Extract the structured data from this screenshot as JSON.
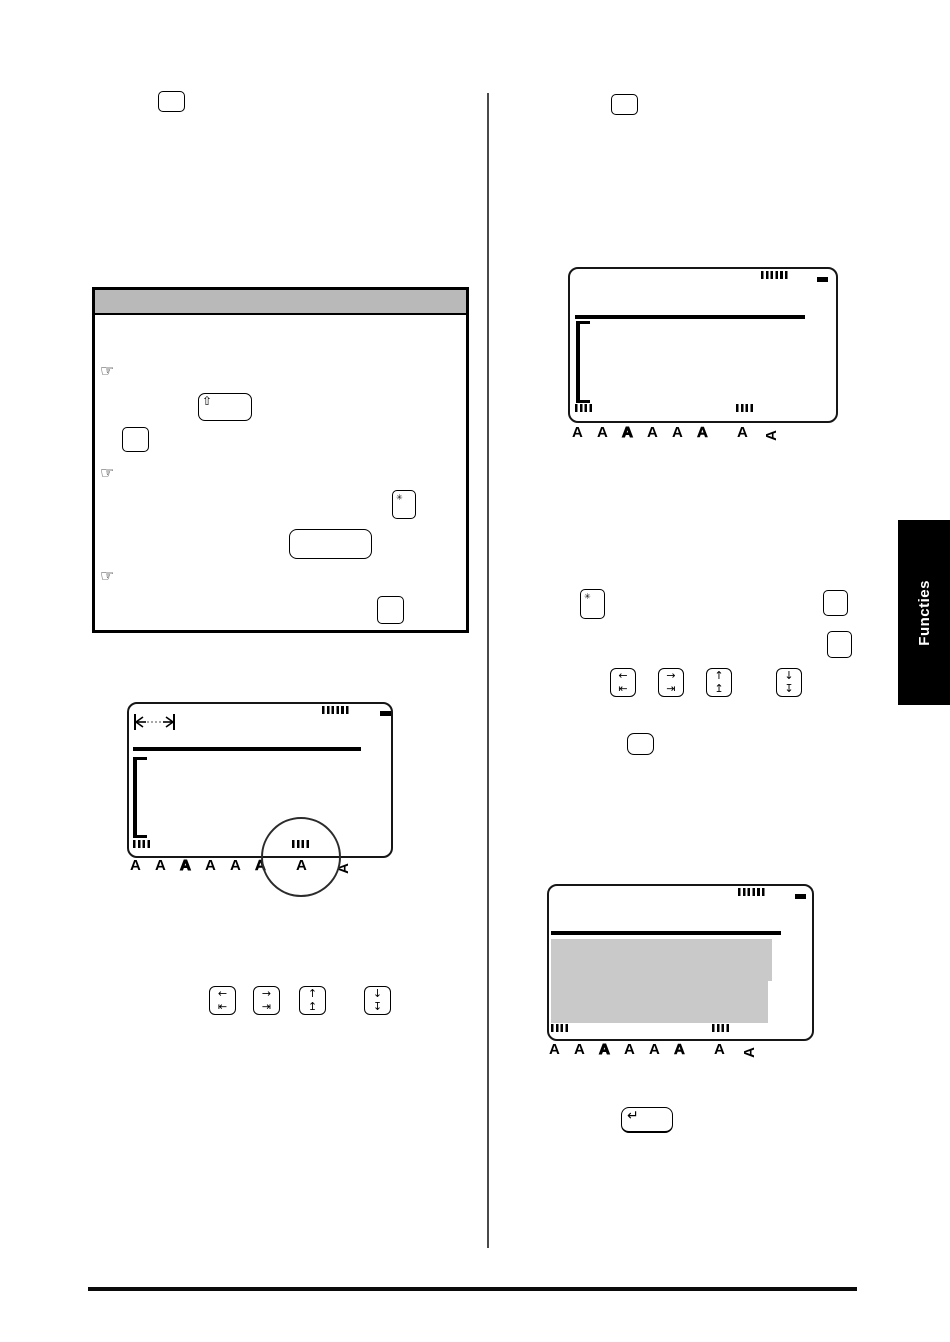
{
  "side_tab": {
    "label": "Functies"
  },
  "colors": {
    "note_header_bg": "#b9b9b9",
    "selection_bg": "#c9c9c9",
    "tab_bg": "#000000",
    "tab_fg": "#ffffff"
  },
  "glyphs": {
    "hand": "☞",
    "shift": "⇧",
    "star": "✳",
    "return": "↵",
    "arrow_left_top": "←",
    "arrow_left_bottom": "⇤",
    "arrow_right_top": "→",
    "arrow_right_bottom": "⇥",
    "arrow_up_top": "↑",
    "arrow_up_bottom": "↥",
    "arrow_down_top": "↓",
    "arrow_down_bottom": "↧"
  },
  "display": {
    "style_letters": [
      "A",
      "A",
      "A",
      "A",
      "A",
      "A"
    ],
    "italic_letter": "A",
    "vertical_letter": "A"
  }
}
